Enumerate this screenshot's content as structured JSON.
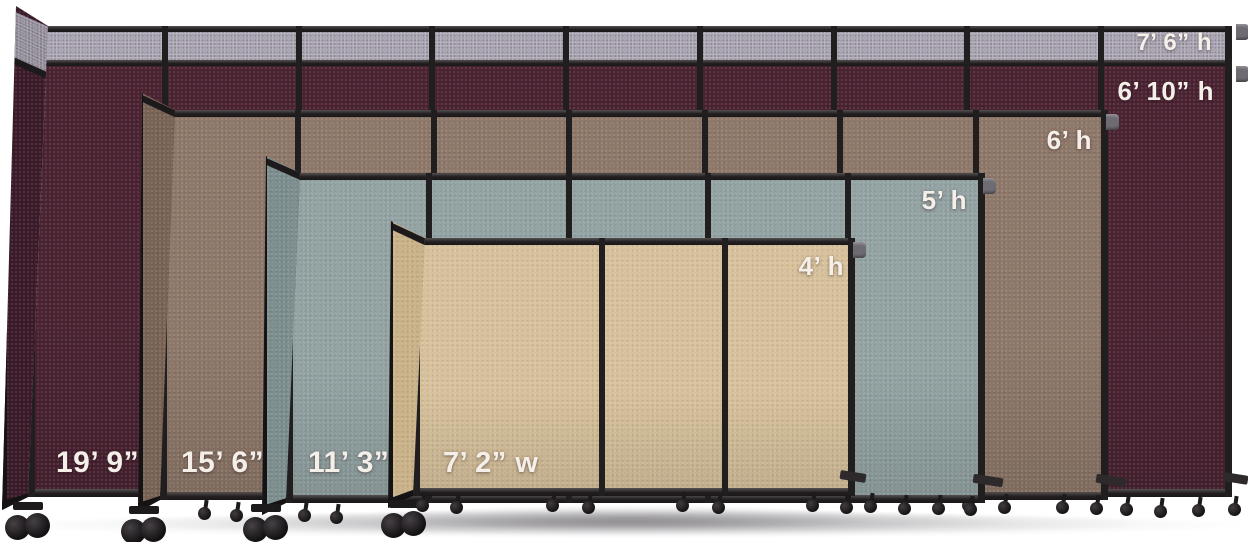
{
  "scene": {
    "description": "Four portable accordion room dividers arranged front-to-back by size, each labeled with its height and width",
    "background_color": "#ffffff",
    "frame_color": "#211e20",
    "label_color": "#f4efe8"
  },
  "dividers": [
    {
      "id": "burgundy",
      "height_labels": [
        "7’ 6” h",
        "6’ 10” h"
      ],
      "width_label": "19’ 9” w",
      "panel_count": 9,
      "fabric_color": "#4a2231",
      "return_color": "#3a1a28",
      "top_band_color": "#a29cab",
      "top_band_return_color": "#8d8795"
    },
    {
      "id": "brown",
      "height_labels": [
        "6’ h"
      ],
      "width_label": "15’ 6” w",
      "panel_count": 7,
      "fabric_color": "#8e7869",
      "return_color": "#786354"
    },
    {
      "id": "slate",
      "height_labels": [
        "5’ h"
      ],
      "width_label": "11’ 3” w",
      "panel_count": 5,
      "fabric_color": "#93a3a3",
      "return_color": "#7d8e8f"
    },
    {
      "id": "sand",
      "height_labels": [
        "4’ h"
      ],
      "width_label": "7’ 2” w",
      "panel_count": 3,
      "fabric_color": "#d8c29c",
      "return_color": "#cab289"
    }
  ]
}
